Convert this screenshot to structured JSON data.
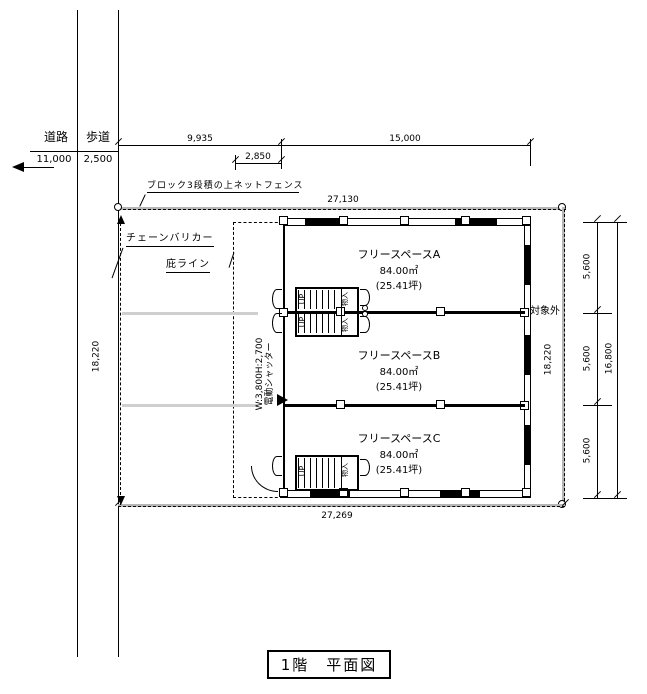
{
  "drawing": {
    "title": "1階　平面図"
  },
  "site": {
    "road_label": "道路",
    "road_width": "11,000",
    "sidewalk_label": "歩道",
    "sidewalk_width": "2,500"
  },
  "dims": {
    "top_left": "9,935",
    "top_right": "15,000",
    "canopy_offset": "2,850",
    "fence_top": "27,130",
    "fence_bottom": "27,269",
    "boundary_left": "18,220",
    "boundary_right": "18,220",
    "bay_top": "5,600",
    "bay_mid": "5,600",
    "bay_bottom": "5,600",
    "building_depth": "16,800"
  },
  "labels": {
    "fence": "ブロック3段積の上ネットフェンス",
    "chain_barricade": "チェーンバリカー",
    "eave_line": "庇ライン",
    "shutter_size": "W:3,800H:2,700",
    "shutter_name": "電動シャッター",
    "out_of_scope": "対象外",
    "up1": "UP",
    "up2": "UP",
    "up3": "UP",
    "closet1": "物入",
    "closet2": "物入",
    "closet3": "物入"
  },
  "spaces": [
    {
      "name": "フリースペースA",
      "area": "84.00㎡",
      "area_tsubo": "(25.41坪)"
    },
    {
      "name": "フリースペースB",
      "area": "84.00㎡",
      "area_tsubo": "(25.41坪)"
    },
    {
      "name": "フリースペースC",
      "area": "84.00㎡",
      "area_tsubo": "(25.41坪)"
    }
  ]
}
